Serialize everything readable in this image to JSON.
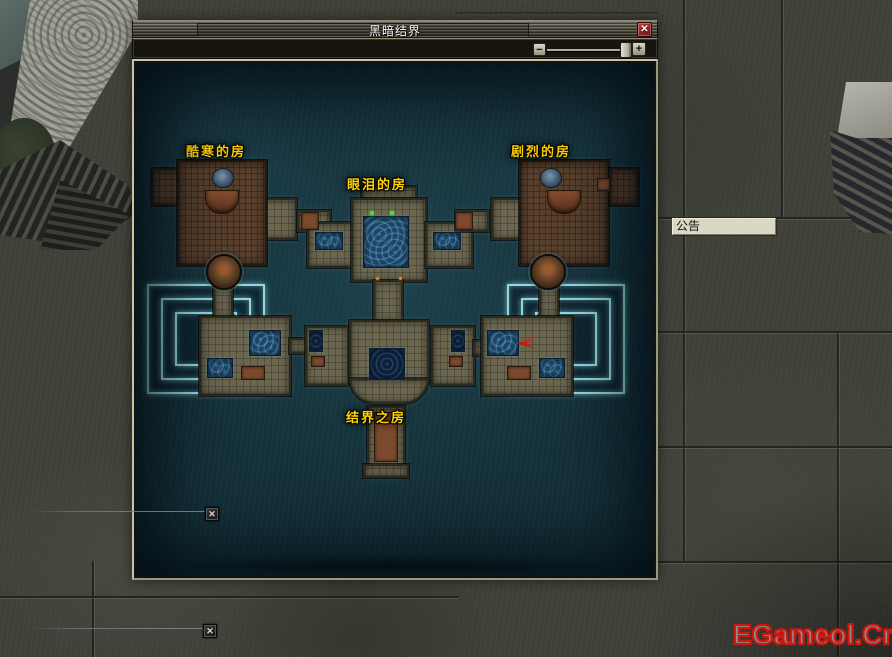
{
  "window": {
    "title": "黑暗结界"
  },
  "titlebar": {
    "close_label": "✕"
  },
  "toolbar": {
    "zoom_out_label": "−",
    "zoom_in_label": "+"
  },
  "map": {
    "rooms": [
      {
        "id": "cold",
        "label": "酷寒的房"
      },
      {
        "id": "tears",
        "label": "眼泪的房"
      },
      {
        "id": "violent",
        "label": "剧烈的房"
      },
      {
        "id": "barrier",
        "label": "结界之房"
      }
    ]
  },
  "announcement": {
    "label": "公告"
  },
  "world_markers": {
    "glyph": "✕"
  },
  "watermark": {
    "text": "EGameol.Cn"
  },
  "colors": {
    "label_gold": "#ffd200",
    "maze_glow": "#8fd8e0",
    "pool_blue": "#1d4666",
    "close_button_red": "#a22020",
    "watermark_red": "#cf1710"
  }
}
